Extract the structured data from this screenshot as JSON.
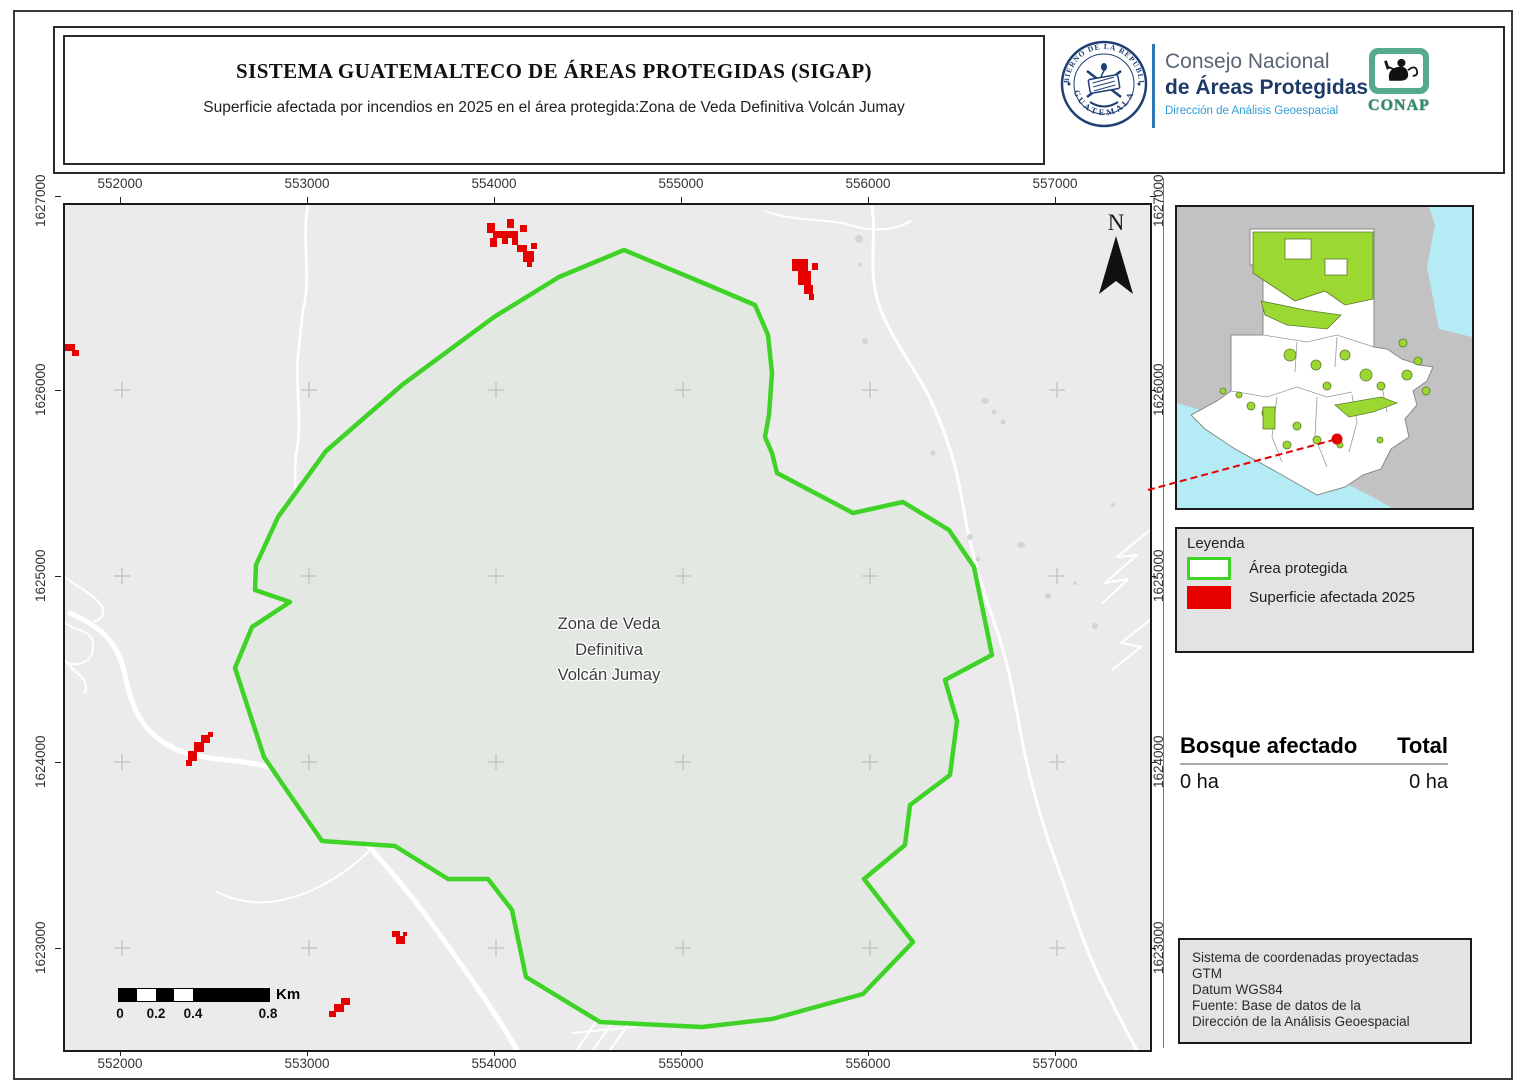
{
  "header": {
    "title": "SISTEMA GUATEMALTECO DE ÁREAS PROTEGIDAS  (SIGAP)",
    "subtitle": "Superficie afectada por incendios en 2025 en el área protegida:Zona de Veda Definitiva Volcán Jumay",
    "seal_text_top": "GOBIERNO DE LA REPÚBLICA",
    "seal_text_bottom": "GUATEMALA",
    "org_line1": "Consejo Nacional",
    "org_line2": "de Áreas Protegidas",
    "org_line3": "Dirección de Análisis Geoespacial",
    "conap_label": "CONAP"
  },
  "map": {
    "x_ticks": [
      "552000",
      "553000",
      "554000",
      "555000",
      "556000",
      "557000"
    ],
    "y_ticks": [
      "1627000",
      "1626000",
      "1625000",
      "1624000",
      "1623000"
    ],
    "area_label_line1": "Zona de Veda",
    "area_label_line2": "Definitiva",
    "area_label_line3": "Volcán Jumay",
    "north_label": "N",
    "scalebar": {
      "t0": "0",
      "t1": "0.2",
      "t2": "0.4",
      "t3": "0.8",
      "unit": "Km"
    }
  },
  "legend": {
    "title": "Leyenda",
    "item1": "Área protegida",
    "item2": "Superficie afectada 2025"
  },
  "stats": {
    "header1": "Bosque afectado",
    "header2": "Total",
    "value1": "0 ha",
    "value2": "0 ha"
  },
  "source_box": {
    "line1": "Sistema de coordenadas proyectadas",
    "line2": "GTM",
    "line3": "Datum WGS84",
    "line4": "Fuente: Base de datos de la",
    "line5": "Dirección de la Análisis Geoespacial"
  },
  "colors": {
    "protected_outline": "#3fd327",
    "protected_fill": "#e3e8e2",
    "affected_fill": "#e60000",
    "inset_protected": "#9bd832",
    "water": "#b5ebf5",
    "map_background": "#ebebeb",
    "accent_blue": "#2e75b6"
  }
}
